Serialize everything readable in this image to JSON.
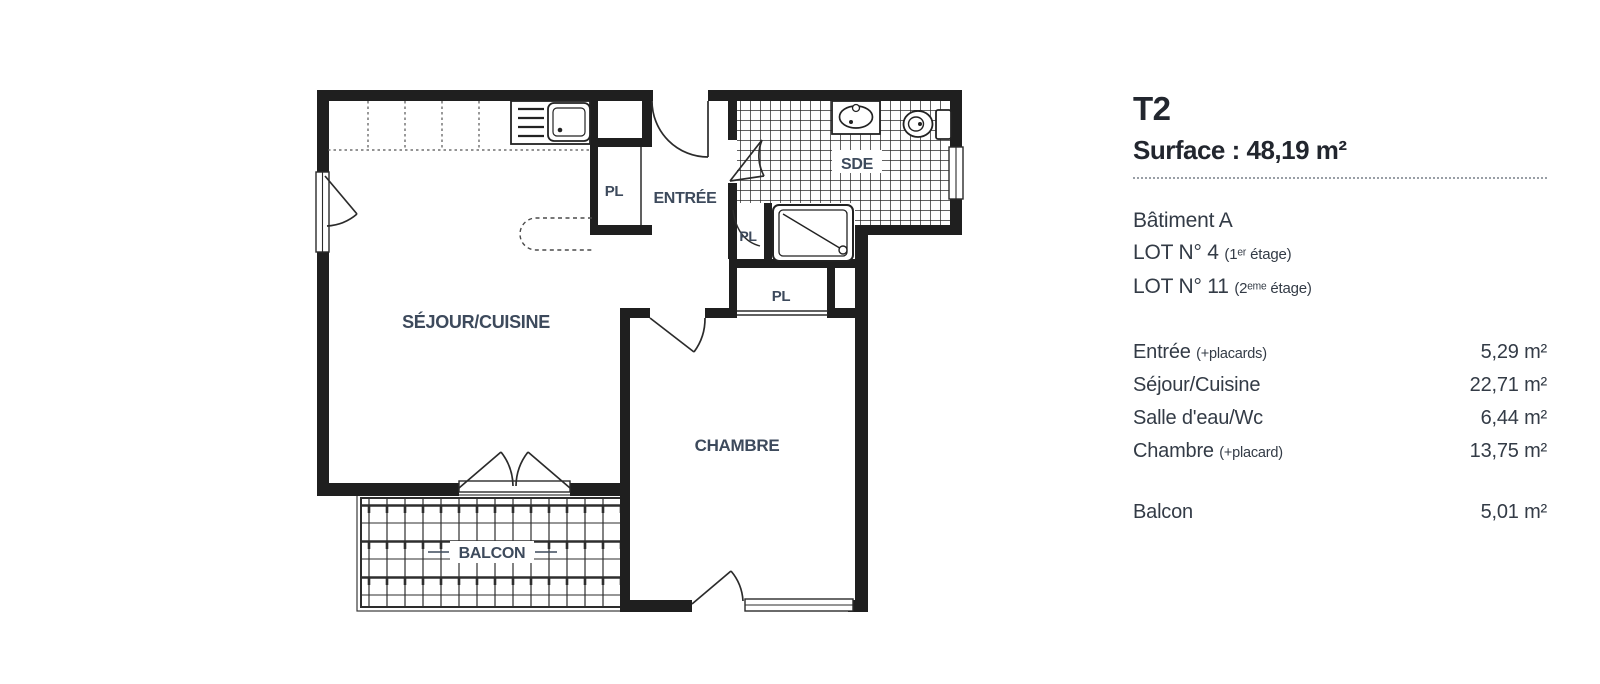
{
  "panel": {
    "type_label": "T2",
    "surface_label": "Surface : 48,19 m²",
    "building": "Bâtiment A",
    "lots": [
      {
        "main": "LOT N° 4",
        "suffix": "(1ᵉʳ étage)"
      },
      {
        "main": "LOT N° 11",
        "suffix": "(2ᵉᵐᵉ étage)"
      }
    ],
    "rooms": [
      {
        "name": "Entrée",
        "suffix": "(+placards)",
        "area": "5,29 m²"
      },
      {
        "name": "Séjour/Cuisine",
        "suffix": "",
        "area": "22,71 m²"
      },
      {
        "name": "Salle d'eau/Wc",
        "suffix": "",
        "area": "6,44 m²"
      },
      {
        "name": "Chambre",
        "suffix": "(+placard)",
        "area": "13,75 m²"
      }
    ],
    "balcony_row": {
      "name": "Balcon",
      "area": "5,01 m²"
    }
  },
  "plan": {
    "labels": {
      "sejour": "SÉJOUR/CUISINE",
      "entree": "ENTRÉE",
      "sde": "SDE",
      "chambre": "CHAMBRE",
      "balcon": "BALCON",
      "pl": "PL"
    },
    "colors": {
      "wall": "#1f1f1f",
      "label": "#3d4a5c",
      "line": "#2b2b2b",
      "text_dark": "#22262e",
      "text_body": "#333b46"
    }
  }
}
